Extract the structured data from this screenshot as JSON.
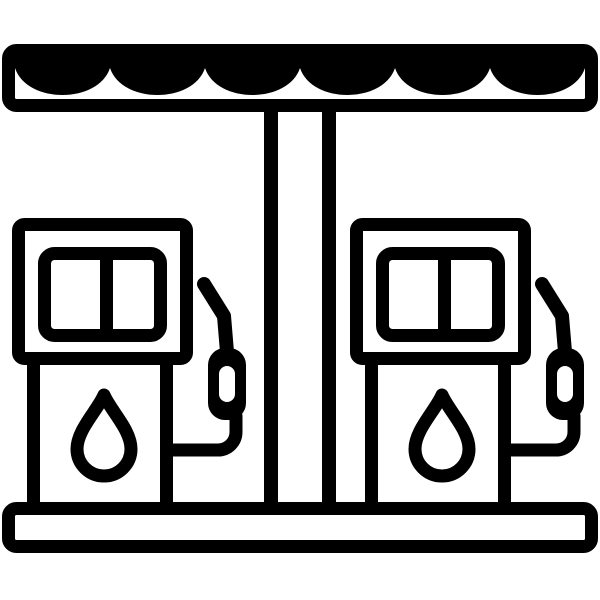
{
  "page": {
    "background": "#ffffff"
  },
  "icon": {
    "name": "gas-station",
    "description": "Black and white line icon of a gas station: a scalloped awning canopy on a central support pillar, two identical fuel pumps each with a two-pane display screen, a fuel drop symbol and a hanging nozzle with hose, standing on a ground base platform",
    "colors": {
      "ink": "#000000",
      "paper": "#ffffff"
    },
    "parts": {
      "canopy": "scalloped awning canopy",
      "pillar": "central support pillar",
      "pump_left": "left fuel pump with display screen, fuel drop symbol and nozzle",
      "pump_right": "right fuel pump with display screen, fuel drop symbol and nozzle",
      "base": "ground base platform"
    },
    "counts": {
      "pumps": 2,
      "canopy_scallops": 6,
      "screen_panes_per_pump": 2
    }
  }
}
